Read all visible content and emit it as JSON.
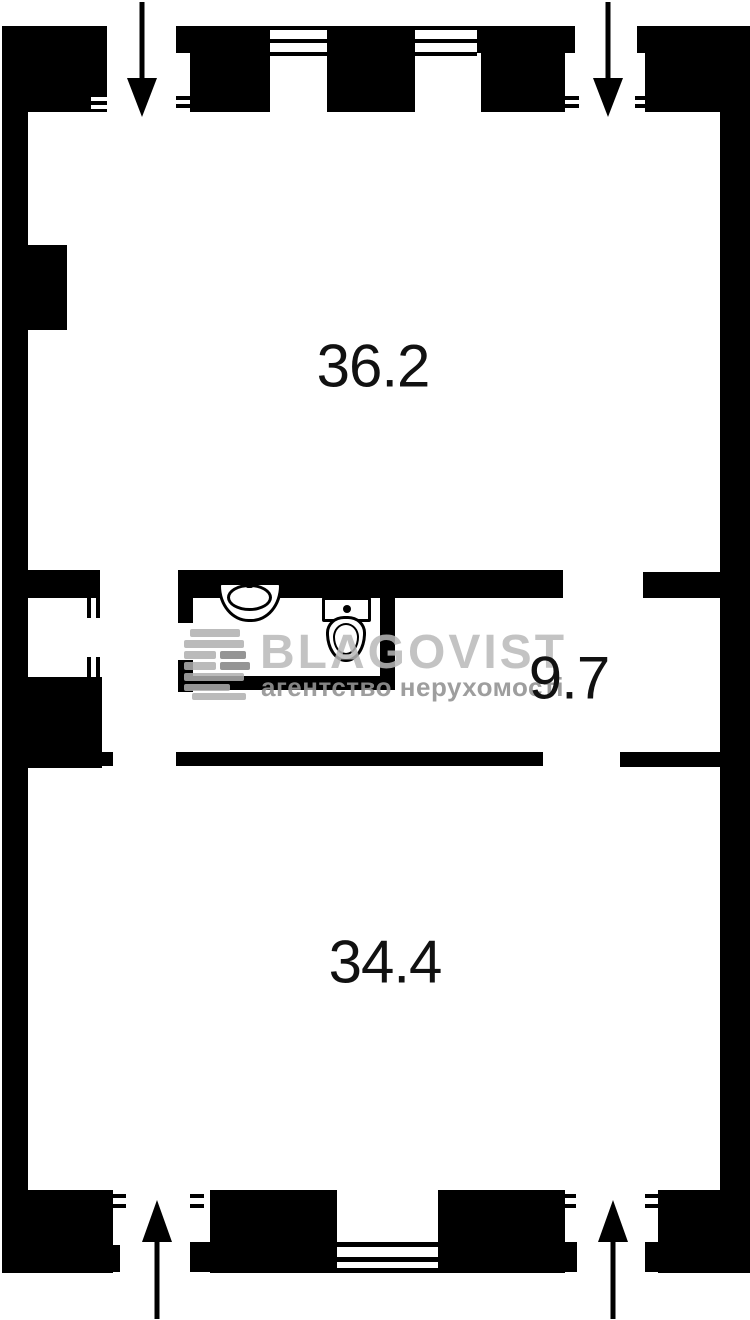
{
  "plan": {
    "type": "apartment-floor-plan",
    "rooms": [
      {
        "name": "upper-room",
        "area": "36.2"
      },
      {
        "name": "middle-room",
        "area": "9.7"
      },
      {
        "name": "lower-room",
        "area": "34.4"
      }
    ],
    "fixtures": [
      "sink-icon",
      "toilet-icon"
    ],
    "entrances": [
      "top-left-down-arrow",
      "top-right-down-arrow",
      "bottom-left-up-arrow",
      "bottom-right-up-arrow"
    ],
    "watermark": {
      "logo": "blagovist-stripes-icon",
      "brand": "BLAGOVIST",
      "tagline": "агентство нерухомості"
    },
    "colors": {
      "wall": "#000000",
      "background": "#ffffff",
      "label_text": "#111111",
      "watermark_brand": "#b9b9b9",
      "watermark_tagline": "#949494"
    }
  }
}
